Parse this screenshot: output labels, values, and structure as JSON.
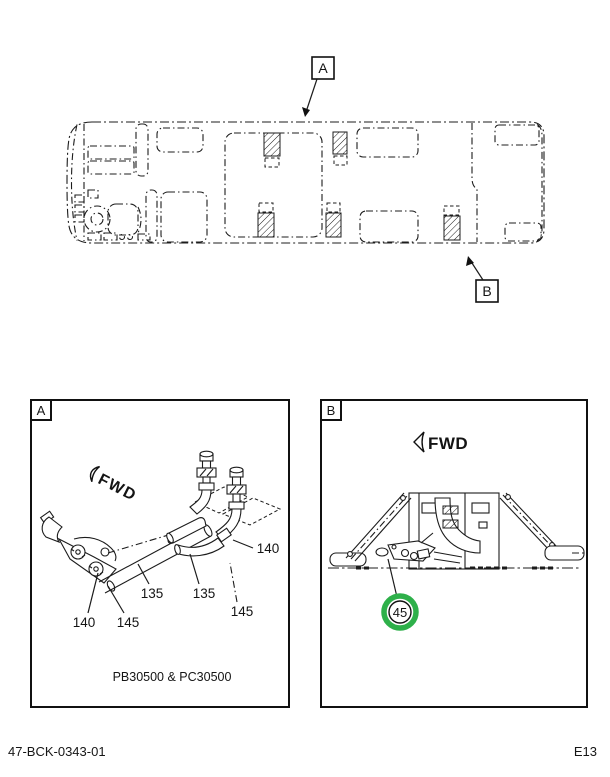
{
  "overview": {
    "callout_a": "A",
    "callout_b": "B"
  },
  "panel_a": {
    "label": "A",
    "fwd_label": "FWD",
    "caption": "PB30500 & PC30500",
    "callouts": {
      "pipe": "135",
      "clamp": "140",
      "hose": "145"
    }
  },
  "panel_b": {
    "label": "B",
    "fwd_label": "FWD",
    "item_ref": "45",
    "ref_ring_color": "#2eb04a"
  },
  "footer": {
    "doc_number": "47-BCK-0343-01",
    "page_code": "E13"
  }
}
